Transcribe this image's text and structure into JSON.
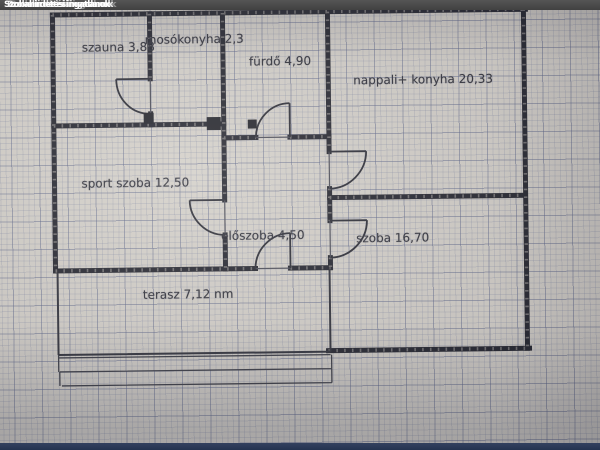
{
  "header": {
    "title": "Szobahirdetési ingatlanok"
  },
  "floorplan": {
    "rooms": [
      {
        "name": "szauna",
        "area": "3,88",
        "label": "szauna 3,88"
      },
      {
        "name": "mosókonyha",
        "area": "2,3",
        "label": "mosókonyha 2,3"
      },
      {
        "name": "fürdő",
        "area": "4,90",
        "label": "fürdő 4,90"
      },
      {
        "name": "nappali+ konyha",
        "area": "20,33",
        "label": "nappali+ konyha 20,33"
      },
      {
        "name": "sport szoba",
        "area": "12,50",
        "label": "sport szoba 12,50"
      },
      {
        "name": "előszoba",
        "area": "4,50",
        "label": "előszoba 4,50"
      },
      {
        "name": "szoba",
        "area": "16,70",
        "label": "szoba 16,70"
      },
      {
        "name": "terasz",
        "area": "7,12 nm",
        "label": "terasz 7,12 nm"
      }
    ]
  },
  "colors": {
    "paper": "#d2cec8",
    "grid_line": "#7880a0",
    "wall": "#23242e",
    "top_bar": "#414141",
    "bottom_bar": "#243350",
    "label_text": "#2e2f39"
  }
}
